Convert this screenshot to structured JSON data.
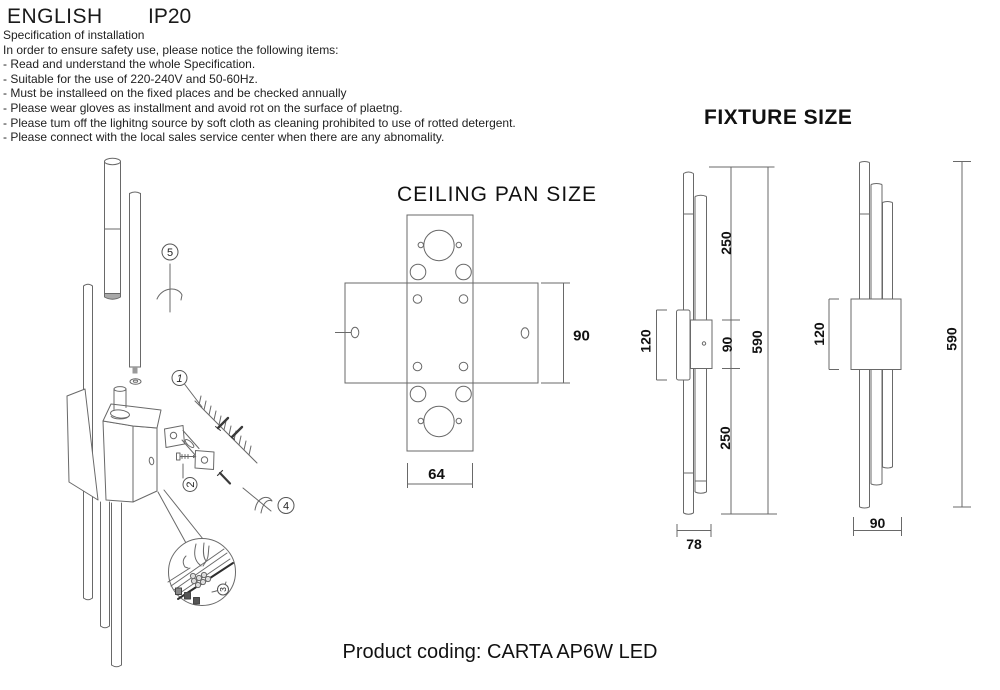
{
  "header": {
    "language": "ENGLISH",
    "ip_rating": "IP20"
  },
  "spec": {
    "title": "Specification of installation",
    "intro": "In order to ensure safety use, please notice the following items:",
    "items": [
      "- Read and understand the whole Specification.",
      "- Suitable for the use of 220-240V and 50-60Hz.",
      "- Must be installeed on the fixed places and be checked annually",
      "- Please wear gloves as installment and avoid rot on the surface of plaetng.",
      "- Please tum off the lighitng source by soft cloth as cleaning prohibited to use of rotted detergent.",
      "- Please connect with the local sales service center when there are any abnomality."
    ]
  },
  "installation": {
    "step1": "1",
    "step2": "2",
    "step3": "3",
    "step4": "4",
    "step5": "5"
  },
  "ceiling_pan": {
    "title": "CEILING PAN SIZE",
    "dim_height": "90",
    "dim_width": "64"
  },
  "fixture": {
    "title": "FIXTURE SIZE",
    "side": {
      "upper": "250",
      "mid": "90",
      "lower": "250",
      "total": "590",
      "bracket": "120",
      "width": "78"
    },
    "front": {
      "bracket": "120",
      "total": "590",
      "width": "90"
    }
  },
  "footer": {
    "product_coding": "Product coding: CARTA AP6W LED"
  }
}
